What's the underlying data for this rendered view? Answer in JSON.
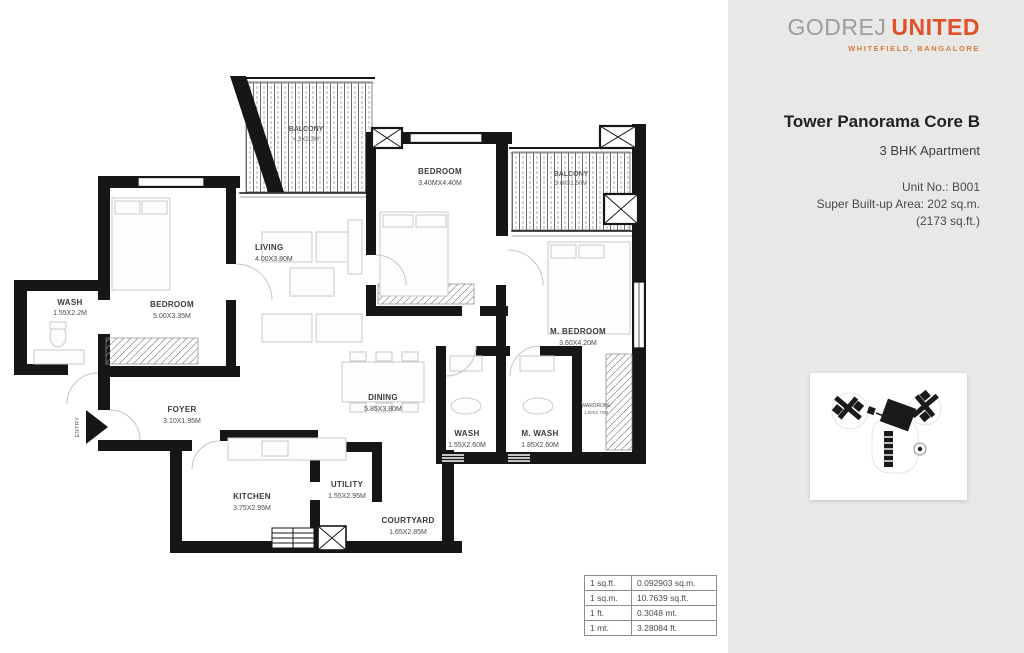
{
  "brand": {
    "name_gray": "GODREJ",
    "name_orange": "UNITED",
    "location": "WHITEFIELD, BANGALORE"
  },
  "panel": {
    "title": "Tower Panorama Core B",
    "subtitle": "3 BHK Apartment",
    "unit_no": "Unit No.: B001",
    "area_m": "Super Built-up Area: 202 sq.m.",
    "area_ft": "(2173 sq.ft.)"
  },
  "plan": {
    "entry_label": "ENTRY",
    "rooms": [
      {
        "name": "WASH",
        "dim": "1.55X2.2M"
      },
      {
        "name": "BEDROOM",
        "dim": "5.00X3.35M"
      },
      {
        "name": "LIVING",
        "dim": "4.00X3.80M"
      },
      {
        "name": "BALCONY",
        "dim": "4.3X2.3M"
      },
      {
        "name": "BEDROOM",
        "dim": "3.40MX4.40M"
      },
      {
        "name": "BALCONY",
        "dim": "3.60X1.50M"
      },
      {
        "name": "M. BEDROOM",
        "dim": "3.60X4.20M"
      },
      {
        "name": "FOYER",
        "dim": "3.10X1.95M"
      },
      {
        "name": "DINING",
        "dim": "5.85X3.80M"
      },
      {
        "name": "WASH",
        "dim": "1.55X2.60M"
      },
      {
        "name": "M. WASH",
        "dim": "1.85X2.60M"
      },
      {
        "name": "WARDROBE",
        "dim": "1.60X2.70M"
      },
      {
        "name": "KITCHEN",
        "dim": "3.75X2.95M"
      },
      {
        "name": "UTILITY",
        "dim": "1.55X2.95M"
      },
      {
        "name": "COURTYARD",
        "dim": "1.65X2.85M"
      }
    ]
  },
  "conversion_table": {
    "rows": [
      [
        "1 sq.ft.",
        "0.092903 sq.m."
      ],
      [
        "1 sq.m.",
        "10.7639 sq.ft."
      ],
      [
        "1 ft.",
        "0.3048 mt."
      ],
      [
        "1 mt.",
        "3.28084 ft."
      ]
    ]
  },
  "colors": {
    "accent_orange": "#e0512a",
    "logo_gray": "#9d9d9b",
    "panel_bg": "#e8e9e7",
    "wall": "#161616"
  }
}
